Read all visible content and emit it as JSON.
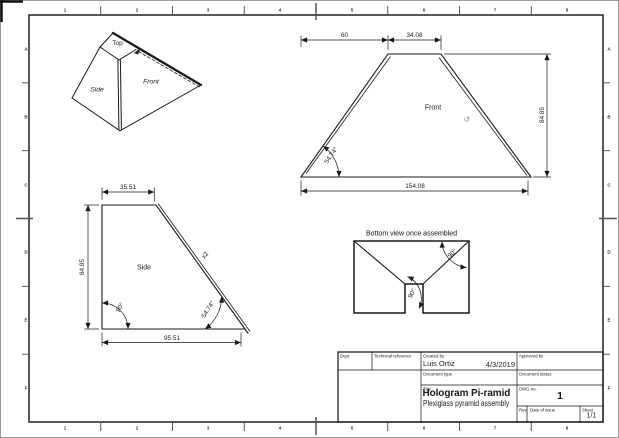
{
  "sheet": {
    "border_columns": [
      "1",
      "2",
      "3",
      "4",
      "5",
      "6",
      "7",
      "8"
    ],
    "border_rows": [
      "A",
      "B",
      "C",
      "D",
      "E",
      "F"
    ]
  },
  "pictorial_view": {
    "top_label": "Top",
    "front_label": "Front",
    "side_label": "Side"
  },
  "front_view": {
    "view_label": "Front",
    "dim_offset": "60",
    "dim_top": "34.08",
    "dim_height": "84.85",
    "dim_bottom": "154.08",
    "angle": "54.74°"
  },
  "side_view": {
    "view_label": "Side",
    "quantity_note": "x2",
    "dim_top": "35.51",
    "dim_height": "84.85",
    "dim_bottom": "95.51",
    "angle_left": "90°",
    "angle_right": "54.74°"
  },
  "bottom_view": {
    "caption": "Bottom view once assembled",
    "angle_corner": "90°",
    "angle_notch": "90°"
  },
  "title_block": {
    "dept_label": "Dept.",
    "technical_reference_label": "Technical reference",
    "created_by_label": "Created by",
    "created_by": "Luis Ortiz",
    "date_created": "4/3/2019",
    "approved_by_label": "Approved by",
    "document_type_label": "Document type",
    "document_status_label": "Document status",
    "title_label": "Title",
    "title": "Hologram Pi-ramid",
    "subtitle": "Plexiglass pyramid assembly",
    "dwg_no_label": "DWG no.",
    "dwg_no": "1",
    "rev_label": "Rev.",
    "date_of_issue_label": "Date of issue",
    "sheet_label": "Sheet",
    "sheet": "1/1"
  },
  "icons": {
    "orbit_cursor": "↺"
  },
  "colors": {
    "line": "#1a1a1a",
    "frame": "#111111",
    "muted": "#8a8a8a"
  }
}
